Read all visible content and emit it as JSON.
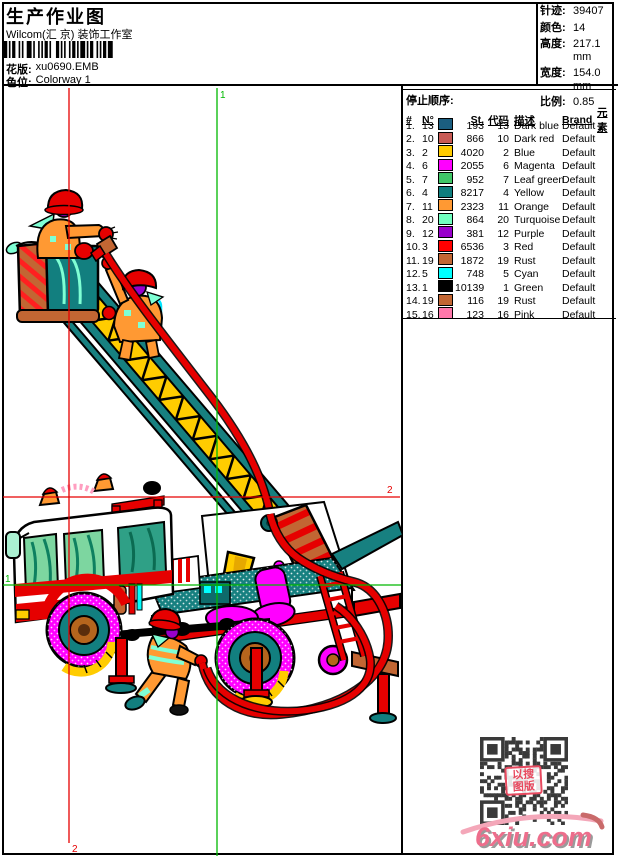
{
  "header": {
    "title": "生产作业图",
    "company": "Wilcom(汇 京) 装饰工作室",
    "pattern_label": "花版:",
    "pattern_value": "xu0690.EMB",
    "colorway_label": "色位:",
    "colorway_value": "Colorway 1"
  },
  "info_panel": {
    "rows": [
      {
        "label": "针迹:",
        "value": "39407"
      },
      {
        "label": "颜色:",
        "value": "14"
      },
      {
        "label": "高度:",
        "value": "217.1 mm"
      },
      {
        "label": "宽度:",
        "value": "154.0 mm"
      },
      {
        "label": "比例:",
        "value": "0.85"
      }
    ]
  },
  "stop_sequence": {
    "title": "停止顺序:",
    "columns": [
      "#",
      "N°",
      "",
      "St.",
      "代码",
      "描述",
      "Brand",
      "元素"
    ],
    "rows": [
      {
        "seq": "1.",
        "needle": "13",
        "swatch": "#1B5E80",
        "stitches": "193",
        "code": "13",
        "description": "Dark blue",
        "brand": "Default"
      },
      {
        "seq": "2.",
        "needle": "10",
        "swatch": "#C85A54",
        "stitches": "866",
        "code": "10",
        "description": "Dark red",
        "brand": "Default"
      },
      {
        "seq": "3.",
        "needle": "2",
        "swatch": "#FFCC00",
        "stitches": "4020",
        "code": "2",
        "description": "Blue",
        "brand": "Default"
      },
      {
        "seq": "4.",
        "needle": "6",
        "swatch": "#FF00FF",
        "stitches": "2055",
        "code": "6",
        "description": "Magenta",
        "brand": "Default"
      },
      {
        "seq": "5.",
        "needle": "7",
        "swatch": "#3FC767",
        "stitches": "952",
        "code": "7",
        "description": "Leaf green",
        "brand": "Default"
      },
      {
        "seq": "6.",
        "needle": "4",
        "swatch": "#0F7F7F",
        "stitches": "8217",
        "code": "4",
        "description": "Yellow",
        "brand": "Default"
      },
      {
        "seq": "7.",
        "needle": "11",
        "swatch": "#FF9933",
        "stitches": "2323",
        "code": "11",
        "description": "Orange",
        "brand": "Default"
      },
      {
        "seq": "8.",
        "needle": "20",
        "swatch": "#70FFC0",
        "stitches": "864",
        "code": "20",
        "description": "Turquoise",
        "brand": "Default"
      },
      {
        "seq": "9.",
        "needle": "12",
        "swatch": "#9900CC",
        "stitches": "381",
        "code": "12",
        "description": "Purple",
        "brand": "Default"
      },
      {
        "seq": "10.",
        "needle": "3",
        "swatch": "#FF0000",
        "stitches": "6536",
        "code": "3",
        "description": "Red",
        "brand": "Default"
      },
      {
        "seq": "11.",
        "needle": "19",
        "swatch": "#C26633",
        "stitches": "1872",
        "code": "19",
        "description": "Rust",
        "brand": "Default"
      },
      {
        "seq": "12.",
        "needle": "5",
        "swatch": "#00FFFF",
        "stitches": "748",
        "code": "5",
        "description": "Cyan",
        "brand": "Default"
      },
      {
        "seq": "13.",
        "needle": "1",
        "swatch": "#000000",
        "stitches": "10139",
        "code": "1",
        "description": "Green",
        "brand": "Default"
      },
      {
        "seq": "14.",
        "needle": "19",
        "swatch": "#C26633",
        "stitches": "116",
        "code": "19",
        "description": "Rust",
        "brand": "Default"
      },
      {
        "seq": "15.",
        "needle": "16",
        "swatch": "#FF77AA",
        "stitches": "123",
        "code": "16",
        "description": "Pink",
        "brand": "Default"
      }
    ]
  },
  "design_area": {
    "markers": {
      "start_label": "1",
      "end_label": "2",
      "start_color": "#00B800",
      "end_color": "#E60000"
    }
  },
  "watermark": {
    "logo_text": "6xiu.com",
    "stamp_line1": "以搜",
    "stamp_line2": "图版"
  }
}
